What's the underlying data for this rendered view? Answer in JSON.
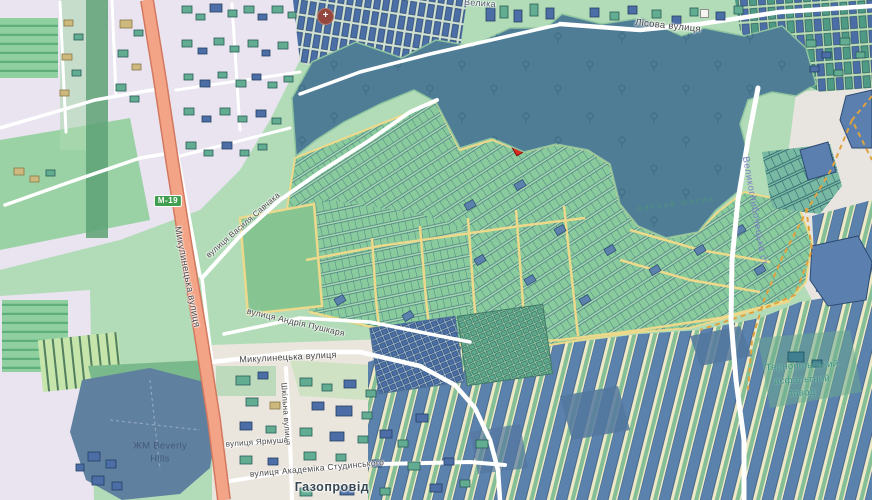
{
  "map": {
    "description": "street map view with allotment gardens, forest and highlighted parcel",
    "labels": {
      "top_partial": "Велика",
      "lisova": "Лісова вулиця",
      "velyko": "Великоглибочецька ст.",
      "plant1": "Тернопільський",
      "plant2": "асфальтний",
      "plant3": "завод",
      "dacha": "дачний масив",
      "savchaka": "вулиця Василя Савчака",
      "pushkarya": "вулиця Андрія Пушкаря",
      "mykulynetska_vertical": "Микулинецька вулиця",
      "mykulynetska_horizontal": "Микулинецька вулиця",
      "shkilna": "Шкільна вулиця",
      "yarmusha": "вулиця Ярмуша",
      "studynskoho": "вулиця Академіка Студинського",
      "gazoprovid": "Газопровід",
      "beverly_line1": "ЖМ Beverly",
      "beverly_line2": "Hills"
    },
    "shield": {
      "text": "М-19"
    },
    "icons": [
      {
        "name": "hospital-cross-icon",
        "glyph": "+"
      },
      {
        "name": "building-poi-icon",
        "glyph": ""
      }
    ],
    "selected_parcel": {
      "color": "#da2c1e"
    }
  },
  "palette": {
    "base_green": "#b2dcb8",
    "forest_teal": "#4f7d95",
    "parcel_green": "#8acb9d",
    "parcel_line": "#3c6f7d",
    "path_yellow": "#ecd98b",
    "strip_blue": "#5b81ad",
    "strip_cream": "#eee9c6",
    "building_blue": "#4c6ea6",
    "building_teal": "#62ad92",
    "urban_lavender": "#e9e4ef",
    "road_orange": "#f3a486",
    "road_orange_casing": "#d2785f",
    "shield_green": "#3f9e4f",
    "label_purple": "#7b82c2",
    "label_teal": "#3d9181",
    "accent_red": "#da2c1e"
  }
}
